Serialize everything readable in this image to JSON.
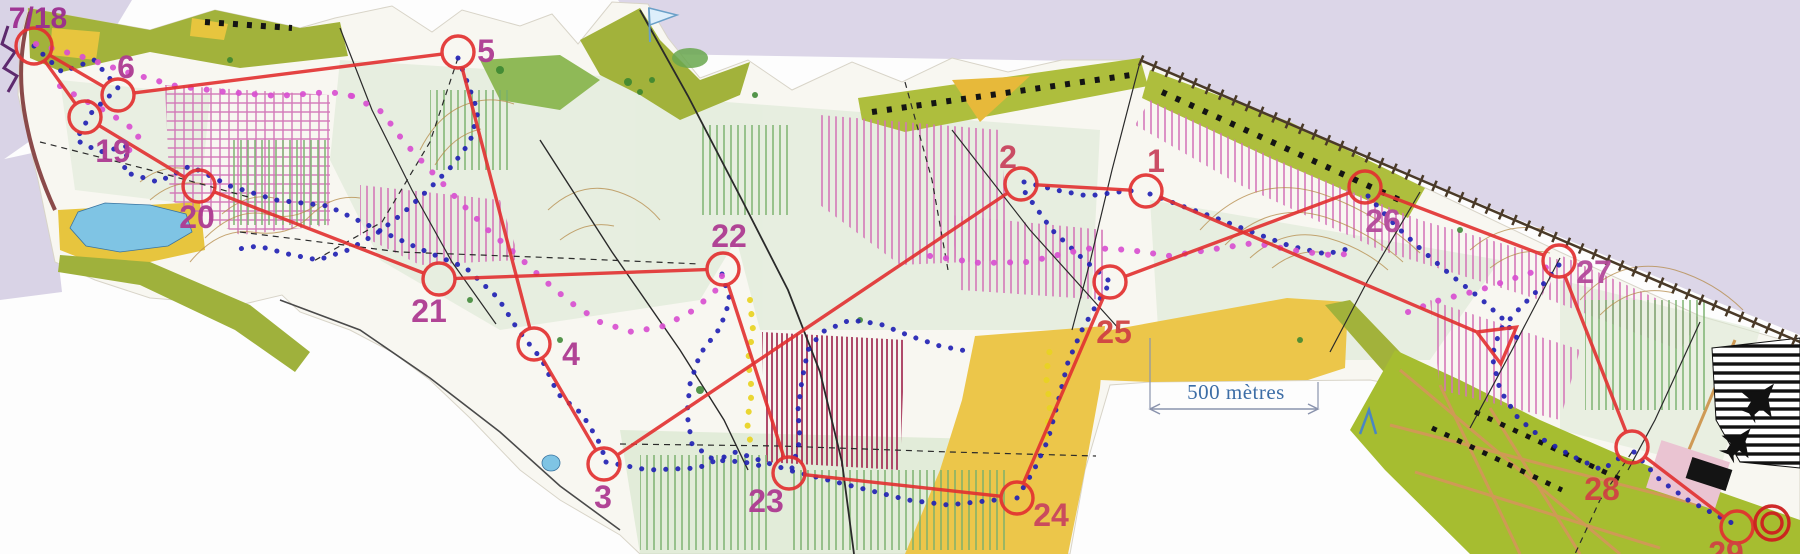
{
  "annotations": {
    "scale_label": "500 mètres",
    "course_label": "7/18"
  },
  "course": {
    "circle_color": "#e23030",
    "line_color": "#e23030",
    "circle_radius": 16,
    "start": {
      "x": 1498,
      "y": 341
    },
    "finish": {
      "x": 1772,
      "y": 523
    },
    "sequence": [
      "start",
      "1",
      "2",
      "3",
      "4",
      "5",
      "6",
      "718",
      "19",
      "20",
      "21",
      "22",
      "23",
      "24",
      "25",
      "26",
      "27",
      "28",
      "29",
      "finish"
    ],
    "controls": [
      {
        "id": "718",
        "label": "7/18",
        "x": 34,
        "y": 46,
        "label_x": 38,
        "label_y": 28,
        "label_size": 30,
        "label_color": "#9c2d90"
      },
      {
        "id": "1",
        "label": "1",
        "x": 1146,
        "y": 191,
        "label_x": 1156,
        "label_y": 172,
        "label_size": 32,
        "label_color": "#c9455f"
      },
      {
        "id": "2",
        "label": "2",
        "x": 1021,
        "y": 184,
        "label_x": 1008,
        "label_y": 168,
        "label_size": 32,
        "label_color": "#c9455f"
      },
      {
        "id": "3",
        "label": "3",
        "x": 604,
        "y": 464,
        "label_x": 603,
        "label_y": 508,
        "label_size": 32,
        "label_color": "#ae3b92"
      },
      {
        "id": "4",
        "label": "4",
        "x": 534,
        "y": 344,
        "label_x": 571,
        "label_y": 365,
        "label_size": 32,
        "label_color": "#ae3b92"
      },
      {
        "id": "5",
        "label": "5",
        "x": 458,
        "y": 52,
        "label_x": 486,
        "label_y": 62,
        "label_size": 32,
        "label_color": "#ae3b92"
      },
      {
        "id": "6",
        "label": "6",
        "x": 118,
        "y": 95,
        "label_x": 126,
        "label_y": 78,
        "label_size": 32,
        "label_color": "#ae3b92"
      },
      {
        "id": "19",
        "label": "19",
        "x": 85,
        "y": 117,
        "label_x": 113,
        "label_y": 162,
        "label_size": 32,
        "label_color": "#ae3b92"
      },
      {
        "id": "20",
        "label": "20",
        "x": 199,
        "y": 186,
        "label_x": 197,
        "label_y": 228,
        "label_size": 32,
        "label_color": "#ae3b92"
      },
      {
        "id": "21",
        "label": "21",
        "x": 439,
        "y": 279,
        "label_x": 429,
        "label_y": 322,
        "label_size": 32,
        "label_color": "#ae3b92"
      },
      {
        "id": "22",
        "label": "22",
        "x": 723,
        "y": 269,
        "label_x": 729,
        "label_y": 247,
        "label_size": 32,
        "label_color": "#ae3b92"
      },
      {
        "id": "23",
        "label": "23",
        "x": 789,
        "y": 473,
        "label_x": 766,
        "label_y": 512,
        "label_size": 32,
        "label_color": "#ae3b92"
      },
      {
        "id": "24",
        "label": "24",
        "x": 1017,
        "y": 498,
        "label_x": 1051,
        "label_y": 526,
        "label_size": 32,
        "label_color": "#c9455f"
      },
      {
        "id": "25",
        "label": "25",
        "x": 1110,
        "y": 282,
        "label_x": 1114,
        "label_y": 343,
        "label_size": 32,
        "label_color": "#d04343"
      },
      {
        "id": "26",
        "label": "26",
        "x": 1365,
        "y": 187,
        "label_x": 1383,
        "label_y": 232,
        "label_size": 32,
        "label_color": "#b44a9b"
      },
      {
        "id": "27",
        "label": "27",
        "x": 1559,
        "y": 261,
        "label_x": 1594,
        "label_y": 283,
        "label_size": 32,
        "label_color": "#b44a9b"
      },
      {
        "id": "28",
        "label": "28",
        "x": 1632,
        "y": 447,
        "label_x": 1602,
        "label_y": 500,
        "label_size": 32,
        "label_color": "#d04343"
      },
      {
        "id": "29",
        "label": "29",
        "x": 1737,
        "y": 527,
        "label_x": 1726,
        "label_y": 564,
        "label_size": 32,
        "label_color": "#d04343"
      }
    ]
  },
  "tracks": [
    {
      "name": "gps-track-blue",
      "color": "#2222b4",
      "dot": 5,
      "gap": 12,
      "polylines": [
        [
          [
            34,
            46
          ],
          [
            62,
            72
          ],
          [
            94,
            60
          ],
          [
            118,
            88
          ],
          [
            92,
            112
          ],
          [
            76,
            140
          ],
          [
            100,
            152
          ],
          [
            128,
            146
          ],
          [
            124,
            172
          ],
          [
            158,
            182
          ],
          [
            190,
            166
          ],
          [
            230,
            186
          ],
          [
            276,
            200
          ],
          [
            328,
            206
          ],
          [
            374,
            228
          ],
          [
            418,
            248
          ],
          [
            466,
            268
          ],
          [
            498,
            298
          ],
          [
            518,
            330
          ],
          [
            542,
            360
          ],
          [
            558,
            394
          ],
          [
            582,
            414
          ],
          [
            598,
            440
          ],
          [
            606,
            460
          ]
        ],
        [
          [
            606,
            462
          ],
          [
            648,
            470
          ],
          [
            698,
            468
          ],
          [
            736,
            452
          ],
          [
            788,
            470
          ],
          [
            828,
            480
          ],
          [
            868,
            490
          ],
          [
            908,
            500
          ],
          [
            948,
            505
          ],
          [
            1005,
            499
          ]
        ],
        [
          [
            1017,
            498
          ],
          [
            1034,
            470
          ],
          [
            1048,
            440
          ],
          [
            1058,
            402
          ],
          [
            1068,
            362
          ],
          [
            1082,
            330
          ],
          [
            1098,
            302
          ],
          [
            1108,
            286
          ]
        ],
        [
          [
            1108,
            280
          ],
          [
            1082,
            258
          ],
          [
            1052,
            230
          ],
          [
            1032,
            202
          ],
          [
            1022,
            188
          ]
        ],
        [
          [
            1024,
            182
          ],
          [
            1056,
            190
          ],
          [
            1088,
            196
          ],
          [
            1118,
            192
          ],
          [
            1142,
            190
          ]
        ],
        [
          [
            1150,
            194
          ],
          [
            1182,
            206
          ],
          [
            1216,
            218
          ],
          [
            1252,
            232
          ],
          [
            1290,
            246
          ],
          [
            1326,
            254
          ],
          [
            1352,
            248
          ]
        ],
        [
          [
            1559,
            265
          ],
          [
            1540,
            288
          ],
          [
            1520,
            308
          ],
          [
            1500,
            330
          ],
          [
            1492,
            356
          ],
          [
            1500,
            390
          ],
          [
            1518,
            418
          ],
          [
            1544,
            440
          ],
          [
            1572,
            456
          ],
          [
            1602,
            470
          ],
          [
            1628,
            452
          ]
        ],
        [
          [
            1634,
            452
          ],
          [
            1660,
            480
          ],
          [
            1688,
            500
          ],
          [
            1714,
            514
          ],
          [
            1734,
            524
          ]
        ],
        [
          [
            458,
            58
          ],
          [
            468,
            84
          ],
          [
            478,
            112
          ],
          [
            470,
            142
          ],
          [
            452,
            166
          ],
          [
            428,
            190
          ],
          [
            402,
            214
          ],
          [
            376,
            234
          ],
          [
            348,
            250
          ],
          [
            318,
            260
          ],
          [
            288,
            254
          ],
          [
            258,
            246
          ],
          [
            232,
            250
          ]
        ],
        [
          [
            722,
            274
          ],
          [
            730,
            300
          ],
          [
            720,
            328
          ],
          [
            700,
            354
          ],
          [
            690,
            384
          ],
          [
            687,
            414
          ],
          [
            692,
            444
          ],
          [
            714,
            460
          ],
          [
            744,
            462
          ],
          [
            770,
            468
          ]
        ],
        [
          [
            792,
            468
          ],
          [
            800,
            440
          ],
          [
            798,
            410
          ],
          [
            802,
            380
          ],
          [
            808,
            350
          ],
          [
            822,
            332
          ],
          [
            850,
            320
          ],
          [
            880,
            324
          ],
          [
            910,
            336
          ],
          [
            940,
            346
          ],
          [
            972,
            352
          ]
        ],
        [
          [
            1368,
            196
          ],
          [
            1396,
            226
          ],
          [
            1424,
            252
          ],
          [
            1452,
            276
          ],
          [
            1480,
            298
          ],
          [
            1504,
            320
          ],
          [
            1520,
            342
          ]
        ]
      ]
    },
    {
      "name": "gps-track-magenta",
      "color": "#d84fd0",
      "dot": 6,
      "gap": 16,
      "polylines": [
        [
          [
            36,
            44
          ],
          [
            80,
            56
          ],
          [
            126,
            72
          ],
          [
            176,
            86
          ],
          [
            226,
            92
          ],
          [
            278,
            96
          ],
          [
            330,
            92
          ],
          [
            352,
            96
          ]
        ],
        [
          [
            352,
            96
          ],
          [
            382,
            112
          ],
          [
            404,
            142
          ],
          [
            432,
            172
          ],
          [
            460,
            202
          ],
          [
            488,
            230
          ],
          [
            518,
            256
          ],
          [
            544,
            280
          ],
          [
            570,
            302
          ],
          [
            600,
            322
          ],
          [
            632,
            332
          ],
          [
            664,
            326
          ],
          [
            694,
            310
          ],
          [
            716,
            290
          ],
          [
            722,
            276
          ]
        ],
        [
          [
            930,
            256
          ],
          [
            980,
            263
          ],
          [
            1028,
            262
          ],
          [
            1062,
            254
          ],
          [
            1092,
            248
          ],
          [
            1130,
            250
          ],
          [
            1170,
            256
          ],
          [
            1208,
            250
          ],
          [
            1254,
            243
          ],
          [
            1298,
            251
          ],
          [
            1338,
            256
          ],
          [
            1358,
            250
          ]
        ],
        [
          [
            1408,
            312
          ],
          [
            1440,
            300
          ],
          [
            1480,
            290
          ],
          [
            1515,
            278
          ],
          [
            1545,
            268
          ],
          [
            1556,
            262
          ]
        ],
        [
          [
            60,
            86
          ],
          [
            80,
            98
          ],
          [
            100,
            108
          ],
          [
            120,
            120
          ],
          [
            140,
            134
          ],
          [
            128,
            152
          ]
        ]
      ]
    },
    {
      "name": "gps-track-yellow",
      "color": "#e8d222",
      "dot": 6,
      "gap": 14,
      "polylines": [
        [
          [
            750,
            300
          ],
          [
            753,
            330
          ],
          [
            748,
            360
          ],
          [
            752,
            392
          ],
          [
            747,
            422
          ],
          [
            752,
            452
          ]
        ],
        [
          [
            1046,
            436
          ],
          [
            1050,
            406
          ],
          [
            1046,
            376
          ],
          [
            1050,
            348
          ]
        ]
      ]
    }
  ]
}
